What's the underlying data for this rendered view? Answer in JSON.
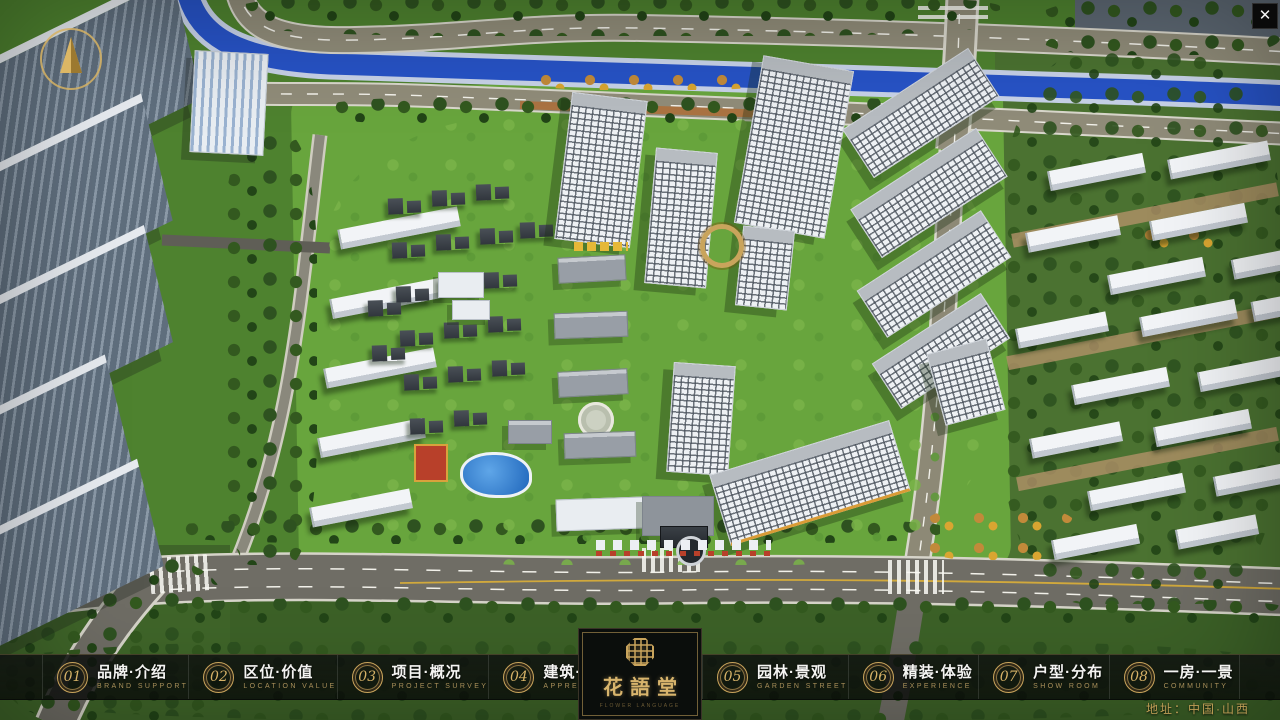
{
  "window": {
    "close_glyph": "✕"
  },
  "menu": {
    "items": [
      {
        "number": "01",
        "title": "品牌·介绍",
        "subtitle": "BRAND SUPPORT"
      },
      {
        "number": "02",
        "title": "区位·价值",
        "subtitle": "LOCATION VALUE"
      },
      {
        "number": "03",
        "title": "项目·概况",
        "subtitle": "PROJECT SURVEY"
      },
      {
        "number": "04",
        "title": "建筑·鉴赏",
        "subtitle": "APPRECIATION"
      },
      {
        "number": "05",
        "title": "园林·景观",
        "subtitle": "GARDEN STREET"
      },
      {
        "number": "06",
        "title": "精装·体验",
        "subtitle": "EXPERIENCE"
      },
      {
        "number": "07",
        "title": "户型·分布",
        "subtitle": "SHOW ROOM"
      },
      {
        "number": "08",
        "title": "一房·一景",
        "subtitle": "COMMUNITY"
      }
    ]
  },
  "logo": {
    "name": "花語堂",
    "tagline": "FLOWER LANGUAGE"
  },
  "footer": {
    "address": "地址：中国·山西"
  },
  "colors": {
    "gold": "#c9a45c",
    "river": "#2753c6",
    "lawn": "#68a53d",
    "road": "#908c79",
    "road_dark": "#6f6d65",
    "forest": "#2c4f1f",
    "building_white": "#eef1f4",
    "accent_red": "#b8402a"
  }
}
